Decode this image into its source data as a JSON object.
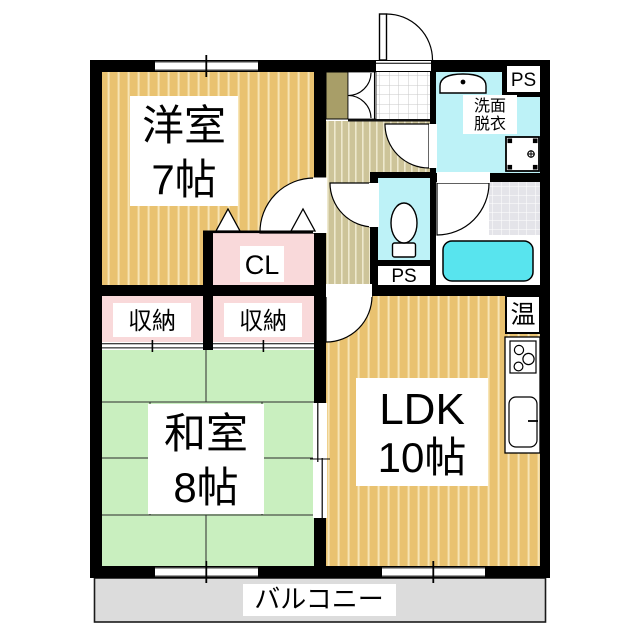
{
  "floorplan": {
    "type": "apartment-floor-plan",
    "rooms": {
      "western": {
        "name": "洋室",
        "size": "7帖"
      },
      "japanese": {
        "name": "和室",
        "size": "8帖"
      },
      "ldk": {
        "name": "LDK",
        "size": "10帖"
      },
      "closet": {
        "label": "CL"
      },
      "storage_left": {
        "label": "収納"
      },
      "storage_right": {
        "label": "収納"
      },
      "washroom": {
        "name_line1": "洗面",
        "name_line2": "脱衣"
      },
      "balcony": {
        "label": "バルコニー"
      }
    },
    "labels": {
      "pipe_space_top": "PS",
      "pipe_space_middle": "PS",
      "water_heater": "温"
    },
    "fixtures": [
      "toilet",
      "bathtub",
      "vanity-sink",
      "washing-machine-pan",
      "gas-stove",
      "kitchen-sink",
      "shoe-cabinet",
      "entrance-door"
    ],
    "colors": {
      "wall": "#000000",
      "wood_floor": "#e9c270",
      "wood_stripe": "#f7e4b4",
      "hall_floor": "#cdc499",
      "hall_stripe": "#eee8cd",
      "tatami_green": "#c9efbf",
      "closet_pink": "#f9d9da",
      "wet_area_cyan": "#bdf2f7",
      "bathtub_cyan": "#58e4ee",
      "bath_tile_gray": "#e4e4e9",
      "balcony_gray": "#dcdcdc",
      "cabinet_khaki": "#a89e68"
    }
  }
}
